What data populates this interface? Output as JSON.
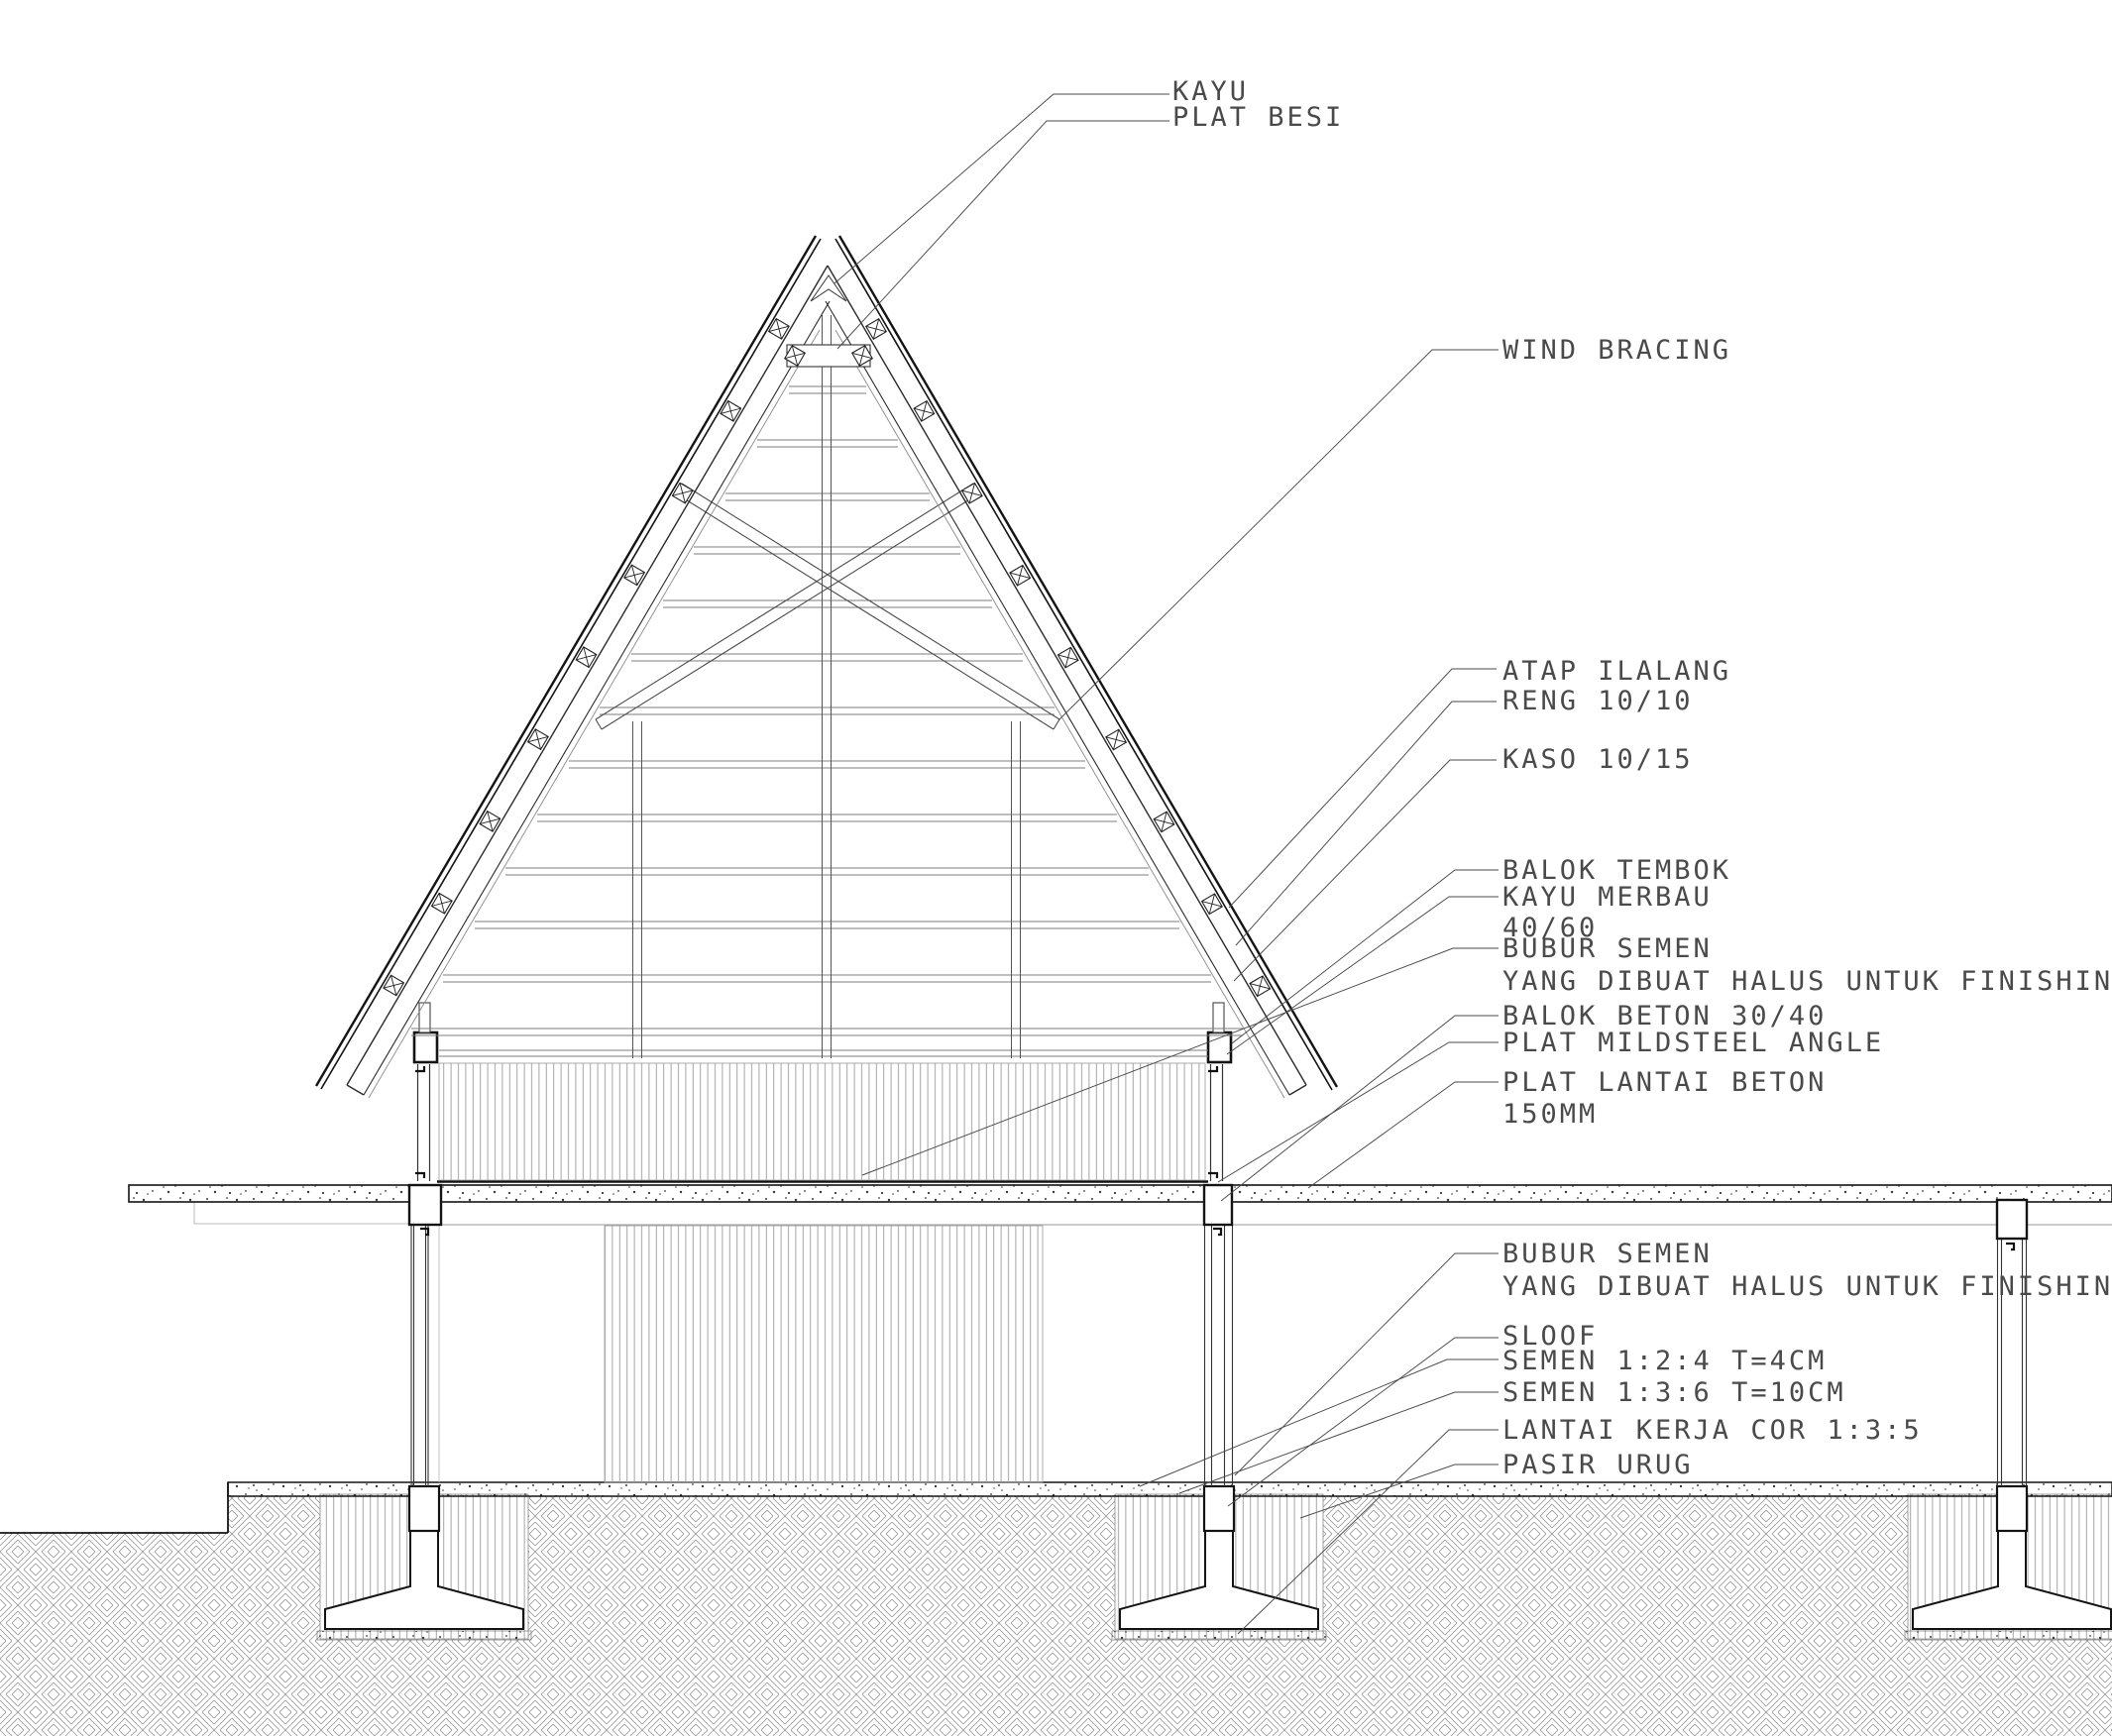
{
  "drawing": {
    "labels": {
      "kayu": {
        "text": "KAYU"
      },
      "plat_besi": {
        "text": "PLAT BESI"
      },
      "wind_bracing": {
        "text": "WIND BRACING"
      },
      "atap_ilalang": {
        "text": "ATAP ILALANG"
      },
      "reng": {
        "text": "RENG 10/10"
      },
      "kaso": {
        "text": "KASO 10/15"
      },
      "balok_tembok": {
        "text": "BALOK TEMBOK"
      },
      "kayu_merbau": {
        "text": "KAYU MERBAU"
      },
      "kayu_merbau_size": {
        "text": "40/60"
      },
      "bubur_semen_atas": {
        "text": "BUBUR SEMEN"
      },
      "bubur_semen_atas2": {
        "text": "YANG DIBUAT HALUS UNTUK FINISHING"
      },
      "balok_beton": {
        "text": "BALOK BETON 30/40"
      },
      "plat_mildsteel": {
        "text": "PLAT MILDSTEEL ANGLE"
      },
      "plat_lantai": {
        "text": "PLAT LANTAI BETON"
      },
      "plat_lantai2": {
        "text": "150MM"
      },
      "bubur_semen_bawah": {
        "text": "BUBUR SEMEN"
      },
      "bubur_semen_bawah2": {
        "text": "YANG DIBUAT HALUS UNTUK FINISHING"
      },
      "sloof": {
        "text": "SLOOF"
      },
      "semen_124": {
        "text": "SEMEN 1:2:4 T=4CM"
      },
      "semen_136": {
        "text": "SEMEN 1:3:6 T=10CM"
      },
      "lantai_kerja": {
        "text": "LANTAI KERJA COR 1:3:5"
      },
      "pasir_urug": {
        "text": "PASIR URUG"
      }
    },
    "colors": {
      "background": "#ffffff",
      "cut_line": "#141414",
      "medium_line": "#4a4a4a",
      "thin_line": "#999999",
      "text": "#4a4a4a"
    }
  }
}
